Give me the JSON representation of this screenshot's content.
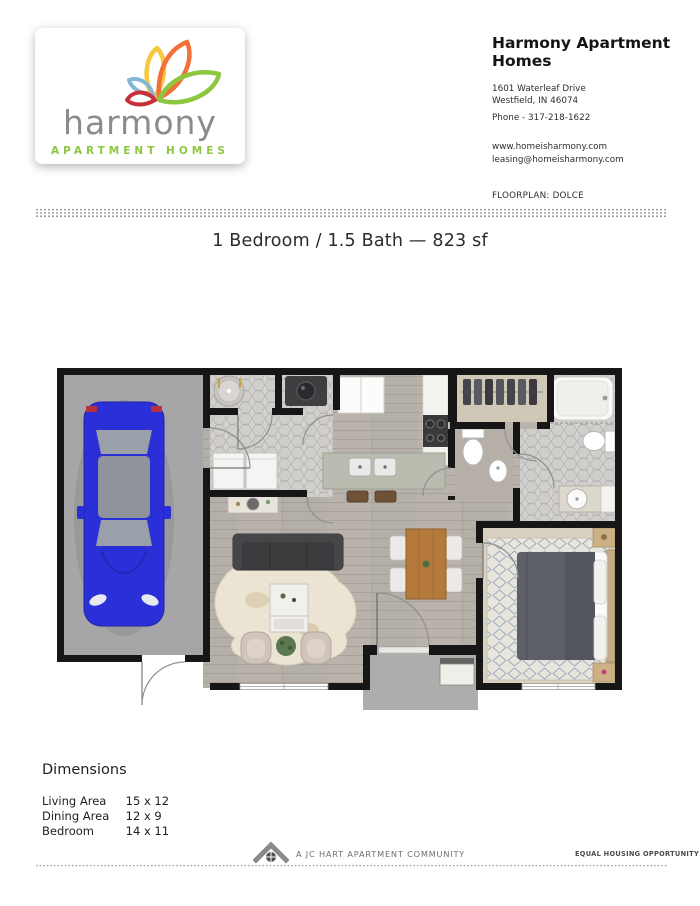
{
  "logo_card": {
    "brand_name": "harmony",
    "brand_tagline": "APARTMENT HOMES",
    "colors": {
      "brand_gray": "#8b8b8b",
      "brand_green": "#8dc63f",
      "petal_orange": "#f2703a",
      "petal_yellow": "#f6c83d",
      "petal_blue": "#85b6d6",
      "petal_red": "#c92f38"
    }
  },
  "contact": {
    "title": "Harmony Apartment Homes",
    "address_line1": "1601 Waterleaf Drive",
    "address_line2": "Westfield, IN 46074",
    "phone": "Phone - 317-218-1622",
    "website": "www.homeisharmony.com",
    "email": "leasing@homeisharmony.com"
  },
  "floorplan_label": "FLOORPLAN: DOLCE",
  "summary_title": "1 Bedroom / 1.5 Bath — 823 sf",
  "dimensions": {
    "heading": "Dimensions",
    "rows": [
      {
        "label": "Living Area",
        "value": "15 x 12"
      },
      {
        "label": "Dining Area",
        "value": "12 x 9"
      },
      {
        "label": "Bedroom",
        "value": "14 x 11"
      }
    ]
  },
  "footer": {
    "community_text": "A JC HART APARTMENT COMMUNITY",
    "equal_housing_text": "EQUAL HOUSING OPPORTUNITY"
  },
  "floorplan_image": {
    "plan_name": "Dolce",
    "rooms": [
      "garage",
      "laundry-entry",
      "powder-room",
      "kitchen",
      "living-room",
      "dining-area",
      "half-bath",
      "walk-in-closet",
      "bathroom",
      "bedroom",
      "entry-porch"
    ],
    "car_color": "#2b2fd8",
    "wall_color": "#161616"
  }
}
